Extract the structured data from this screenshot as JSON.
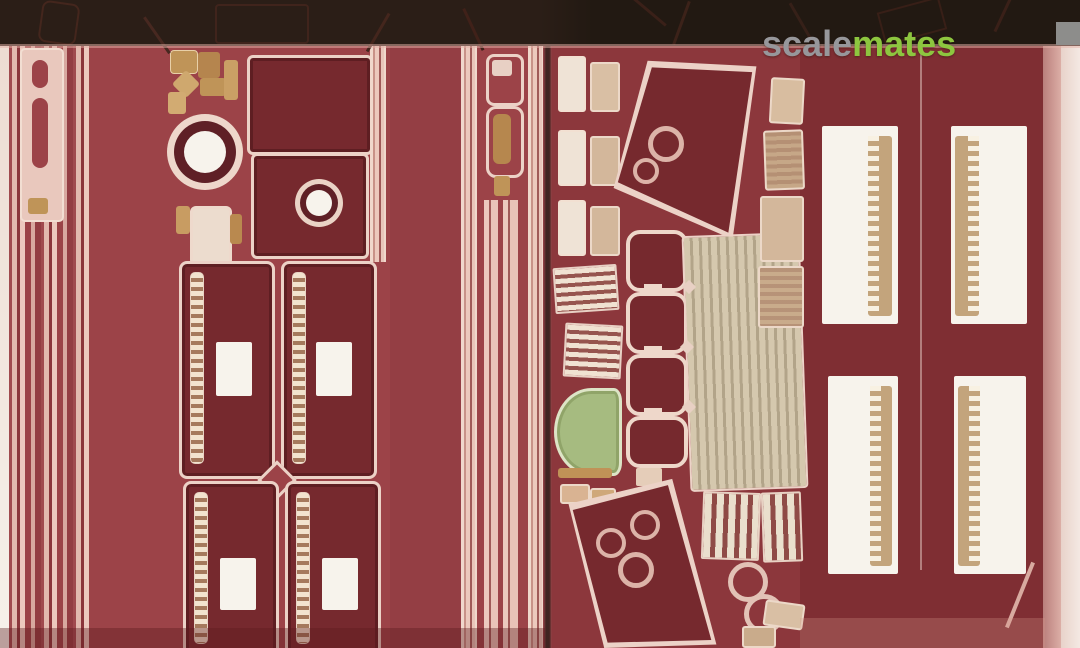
{
  "watermark": {
    "segments": [
      {
        "text": "scale",
        "color": "#97979b"
      },
      {
        "text": "mates",
        "color": "#8dc63f"
      }
    ]
  },
  "photo": {
    "subject": "Macro photograph of two dark-red photo-etched metal detail frets laid side by side, parts outlined in pale pink with white backing visible through cut-outs",
    "colors": {
      "fret_red": "#9c4348",
      "fret_red_mid": "#8c373c",
      "fret_red_dark": "#7f2e33",
      "panel_maroon": "#76292e",
      "etch_outline": "#ecd2c7",
      "brass_tan": "#bf9458",
      "film_green": "#a6bb80",
      "shadow_band": "#281b15",
      "white_backing": "#f7f3ec",
      "watermark_gray": "#97979b",
      "watermark_green": "#8dc63f"
    }
  }
}
